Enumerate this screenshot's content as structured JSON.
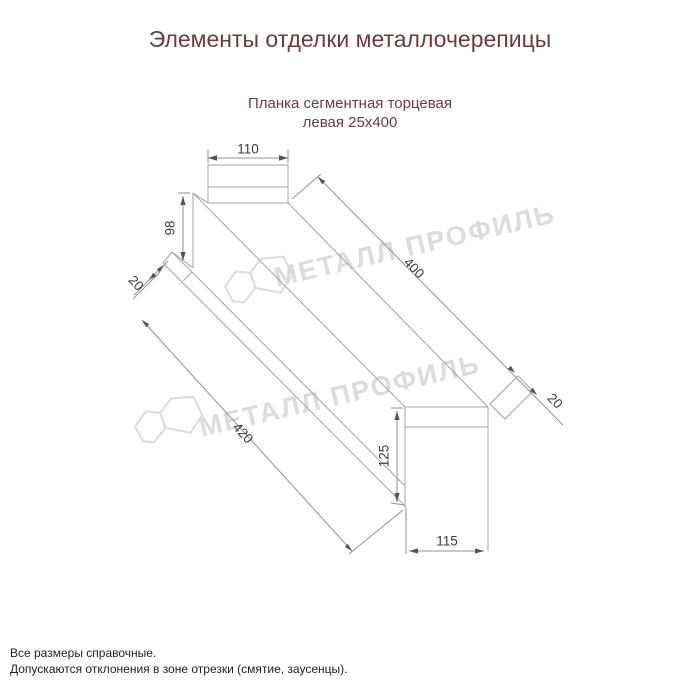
{
  "title": "Элементы отделки металлочерепицы",
  "subtitle": {
    "line1": "Планка сегментная торцевая",
    "line2": "левая 25х400"
  },
  "watermark": {
    "text": "МЕТАЛЛ ПРОФИЛЬ"
  },
  "drawing": {
    "dimensions": {
      "top_width": "110",
      "left_height": "98",
      "left_fold": "20",
      "length_top": "400",
      "length_bottom": "420",
      "right_fold": "20",
      "right_height": "125",
      "bottom_width": "115"
    }
  },
  "notes": {
    "line1": "Все размеры справочные.",
    "line2": "Допускаются отклонения в зоне отрезки (смятие, заусенцы)."
  },
  "colors": {
    "heading": "#6d3a3e",
    "drawing_line": "#a0a4a7",
    "dimension_line": "#8f9396",
    "dimension_text": "#3c3c3c",
    "watermark": "#dcdcdc",
    "notes_text": "#1f1f1f",
    "background": "#ffffff"
  }
}
